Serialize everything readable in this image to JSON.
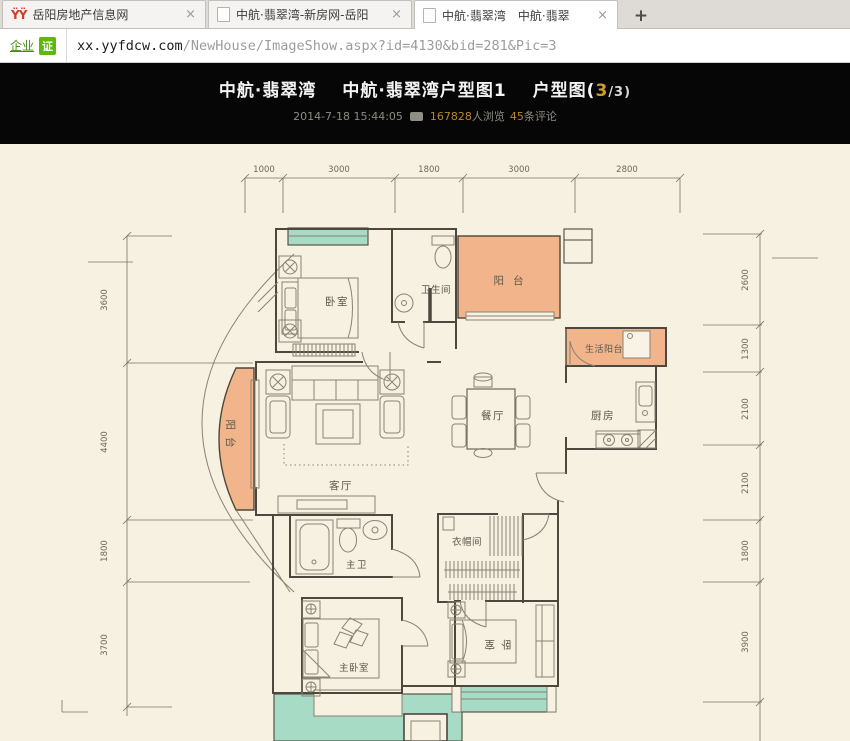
{
  "browser": {
    "tab_bar": {
      "tabs": [
        {
          "title": "岳阳房地产信息网"
        },
        {
          "title": "中航·翡翠湾-新房网-岳阳"
        },
        {
          "title": "中航·翡翠湾　中航·翡翠"
        }
      ],
      "close_glyph": "×",
      "new_tab_glyph": "+",
      "favicon_glyph": "ŸŸ"
    },
    "address_bar": {
      "cert_text": "企业",
      "cert_badge": "证",
      "url_host": "xx.yyfdcw.com",
      "url_path": "/NewHouse/ImageShow.aspx?id=4130&bid=281&Pic=3"
    }
  },
  "header": {
    "title_part1": "中航·翡翠湾",
    "title_part2": "中航·翡翠湾户型图1",
    "title_part3_prefix": "户型图(",
    "title_page_current": "3",
    "title_page_suffix": "/3)",
    "date": "2014-7-18 15:44:05",
    "views_count": "167828",
    "views_label": "人浏览",
    "comments_count": "45",
    "comments_label": "条评论"
  },
  "floorplan": {
    "rooms": {
      "bedroom_top": "卧室",
      "bathroom": "卫生间",
      "balcony_top": "阳台",
      "laundry_balcony": "生活阳台",
      "kitchen": "厨房",
      "dining": "餐厅",
      "living": "客厅",
      "balcony_left": "阳台",
      "master_bath": "主卫",
      "closet": "衣帽间",
      "master_bedroom": "主卧室",
      "bedroom_bottom": "卧室"
    },
    "dimensions": {
      "top": [
        "1000",
        "3000",
        "1800",
        "3000",
        "2800"
      ],
      "left": [
        "3600",
        "4400",
        "1800",
        "3700"
      ],
      "right": [
        "2600",
        "1300",
        "2100",
        "2100",
        "1800",
        "3900"
      ]
    },
    "colors": {
      "balcony_fill": "#f2b58b",
      "window_fill": "#a7dbc6",
      "wall": "#4d473d",
      "background": "#f6f1e0",
      "accent": "#d09a34"
    }
  }
}
